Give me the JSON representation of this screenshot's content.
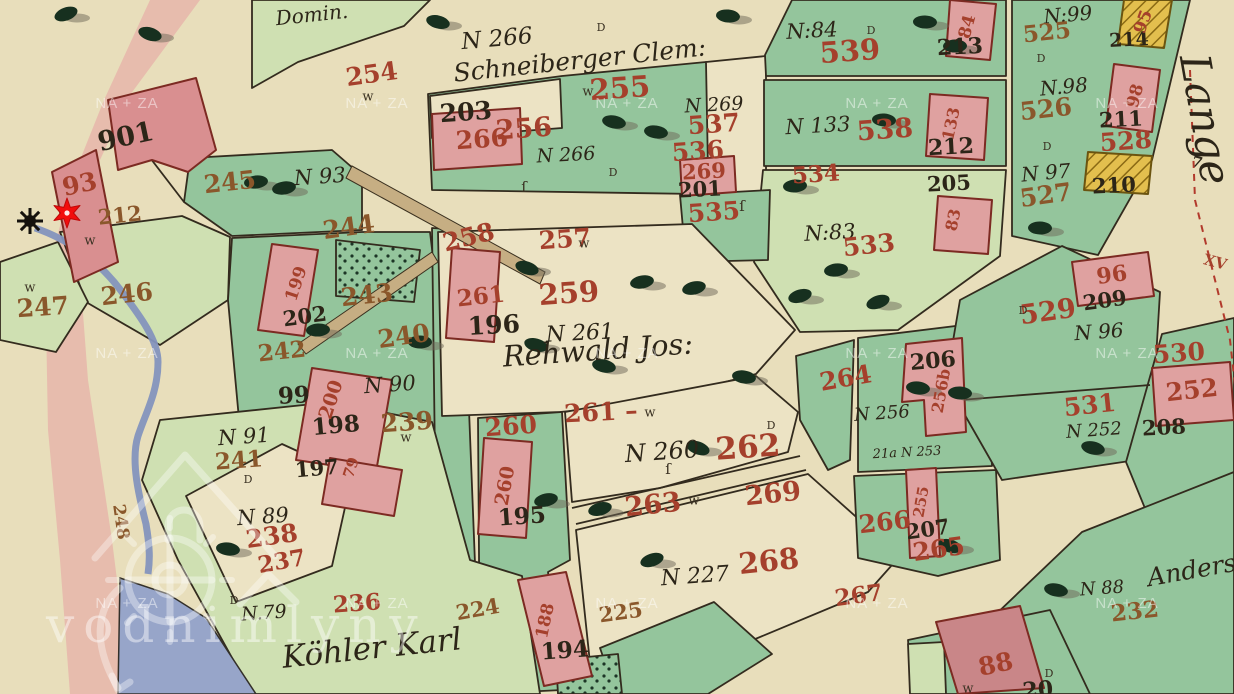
{
  "viewer": {
    "watermark": {
      "tile_text": "NA + ZA",
      "brand_text": "vodnimlyny",
      "logo_name": "vodnimlyny-watermill-logo",
      "tile_xs": [
        127,
        377,
        627,
        877,
        1127
      ],
      "tile_ys": [
        108,
        358,
        608
      ]
    },
    "marker": {
      "name": "mill-location-marker",
      "shape": "six-point-star",
      "color": "#f20d0d",
      "x": 67,
      "y": 213
    },
    "mill_wheel_symbol": {
      "x": 30,
      "y": 221
    }
  },
  "palette": {
    "paper": "#e8debb",
    "green_dark": "#94c59c",
    "green_light": "#cfe0b2",
    "cream_parcel": "#ece3c4",
    "building_pink": "#dfa1a0",
    "building_yellow": "#e3bf4e",
    "water": "#97a5c9",
    "road_band_pink": "#e6b6aa",
    "label_red": "#a5402c",
    "label_brown": "#8a572b",
    "ink": "#2c2518"
  },
  "labels": [
    {
      "t": "Domin.",
      "x": 312,
      "y": 16,
      "s": 20,
      "r": -6,
      "k": "script"
    },
    {
      "t": "Schneiberger Clem:",
      "x": 580,
      "y": 62,
      "s": 25,
      "r": -6,
      "k": "script"
    },
    {
      "t": "Rehwald Jos:",
      "x": 598,
      "y": 352,
      "s": 29,
      "r": -4,
      "k": "script"
    },
    {
      "t": "Köhler Karl",
      "x": 372,
      "y": 650,
      "s": 31,
      "r": -6,
      "k": "script"
    },
    {
      "t": "Anders",
      "x": 1192,
      "y": 572,
      "s": 25,
      "r": -10,
      "k": "script"
    },
    {
      "t": "Lange",
      "x": 1202,
      "y": 120,
      "s": 42,
      "r": 80,
      "k": "script"
    },
    {
      "t": "N 266",
      "x": 497,
      "y": 40,
      "s": 23,
      "r": -5,
      "k": "script"
    },
    {
      "t": "N 266",
      "x": 566,
      "y": 156,
      "s": 19,
      "r": -3,
      "k": "script"
    },
    {
      "t": "N 269",
      "x": 714,
      "y": 106,
      "s": 19,
      "r": -3,
      "k": "script"
    },
    {
      "t": "N:84",
      "x": 812,
      "y": 32,
      "s": 21,
      "r": -3,
      "k": "script"
    },
    {
      "t": "N 133",
      "x": 818,
      "y": 127,
      "s": 21,
      "r": -3,
      "k": "script"
    },
    {
      "t": "N:83",
      "x": 830,
      "y": 234,
      "s": 21,
      "r": -3,
      "k": "script"
    },
    {
      "t": "N:99",
      "x": 1068,
      "y": 16,
      "s": 20,
      "r": -5,
      "k": "script"
    },
    {
      "t": "N.98",
      "x": 1064,
      "y": 88,
      "s": 20,
      "r": -5,
      "k": "script"
    },
    {
      "t": "N 97",
      "x": 1046,
      "y": 174,
      "s": 20,
      "r": -5,
      "k": "script"
    },
    {
      "t": "N 93",
      "x": 320,
      "y": 178,
      "s": 21,
      "r": -4,
      "k": "script"
    },
    {
      "t": "N 90",
      "x": 390,
      "y": 386,
      "s": 21,
      "r": -4,
      "k": "script"
    },
    {
      "t": "N 91",
      "x": 244,
      "y": 438,
      "s": 21,
      "r": -4,
      "k": "script"
    },
    {
      "t": "N 89",
      "x": 263,
      "y": 518,
      "s": 21,
      "r": -4,
      "k": "script"
    },
    {
      "t": "N.79",
      "x": 264,
      "y": 614,
      "s": 19,
      "r": -4,
      "k": "script"
    },
    {
      "t": "N 261",
      "x": 580,
      "y": 334,
      "s": 22,
      "r": -3,
      "k": "script"
    },
    {
      "t": "N 260",
      "x": 662,
      "y": 453,
      "s": 24,
      "r": -4,
      "k": "script"
    },
    {
      "t": "N 227",
      "x": 695,
      "y": 577,
      "s": 22,
      "r": -4,
      "k": "script"
    },
    {
      "t": "N 256",
      "x": 882,
      "y": 414,
      "s": 18,
      "r": -4,
      "k": "script"
    },
    {
      "t": "N 96",
      "x": 1099,
      "y": 333,
      "s": 20,
      "r": -4,
      "k": "script"
    },
    {
      "t": "N 252",
      "x": 1094,
      "y": 431,
      "s": 18,
      "r": -4,
      "k": "script"
    },
    {
      "t": "N 88",
      "x": 1102,
      "y": 589,
      "s": 18,
      "r": -4,
      "k": "script"
    },
    {
      "t": "21a N 253",
      "x": 907,
      "y": 453,
      "s": 13,
      "r": -3,
      "k": "script"
    },
    {
      "t": "901",
      "x": 126,
      "y": 138,
      "s": 27,
      "r": -12,
      "k": "black"
    },
    {
      "t": "203",
      "x": 466,
      "y": 114,
      "s": 25,
      "r": -4,
      "k": "black"
    },
    {
      "t": "196",
      "x": 494,
      "y": 327,
      "s": 25,
      "r": -3,
      "k": "black"
    },
    {
      "t": "195",
      "x": 522,
      "y": 518,
      "s": 23,
      "r": -4,
      "k": "black"
    },
    {
      "t": "194",
      "x": 565,
      "y": 652,
      "s": 23,
      "r": -4,
      "k": "black"
    },
    {
      "t": "197",
      "x": 317,
      "y": 470,
      "s": 21,
      "r": -5,
      "k": "black"
    },
    {
      "t": "198",
      "x": 336,
      "y": 427,
      "s": 23,
      "r": -5,
      "k": "black"
    },
    {
      "t": "202",
      "x": 305,
      "y": 318,
      "s": 21,
      "r": -8,
      "k": "black"
    },
    {
      "t": "99",
      "x": 294,
      "y": 397,
      "s": 23,
      "r": -3,
      "k": "black"
    },
    {
      "t": "201",
      "x": 700,
      "y": 191,
      "s": 21,
      "r": -3,
      "k": "black"
    },
    {
      "t": "205",
      "x": 949,
      "y": 185,
      "s": 21,
      "r": -3,
      "k": "black"
    },
    {
      "t": "206",
      "x": 933,
      "y": 362,
      "s": 22,
      "r": -5,
      "k": "black"
    },
    {
      "t": "207",
      "x": 928,
      "y": 531,
      "s": 21,
      "r": -8,
      "k": "black"
    },
    {
      "t": "208",
      "x": 1164,
      "y": 429,
      "s": 21,
      "r": -3,
      "k": "black"
    },
    {
      "t": "209",
      "x": 1105,
      "y": 302,
      "s": 21,
      "r": -8,
      "k": "black"
    },
    {
      "t": "210",
      "x": 1114,
      "y": 187,
      "s": 21,
      "r": -3,
      "k": "black"
    },
    {
      "t": "211",
      "x": 1121,
      "y": 121,
      "s": 21,
      "r": -3,
      "k": "black"
    },
    {
      "t": "212",
      "x": 951,
      "y": 148,
      "s": 22,
      "r": -3,
      "k": "black"
    },
    {
      "t": "213",
      "x": 960,
      "y": 48,
      "s": 22,
      "r": -3,
      "k": "black"
    },
    {
      "t": "214",
      "x": 1129,
      "y": 41,
      "s": 19,
      "r": -3,
      "k": "black"
    },
    {
      "t": "20",
      "x": 1038,
      "y": 691,
      "s": 22,
      "r": -5,
      "k": "black"
    },
    {
      "t": "7",
      "x": 1197,
      "y": 163,
      "s": 15,
      "r": 15,
      "k": "black"
    },
    {
      "t": "93",
      "x": 80,
      "y": 186,
      "s": 25,
      "r": -12,
      "k": "red"
    },
    {
      "t": "212",
      "x": 120,
      "y": 217,
      "s": 21,
      "r": -6,
      "k": "brown"
    },
    {
      "t": "245",
      "x": 230,
      "y": 184,
      "s": 25,
      "r": -6,
      "k": "brown"
    },
    {
      "t": "244",
      "x": 349,
      "y": 229,
      "s": 25,
      "r": -8,
      "k": "brown"
    },
    {
      "t": "243",
      "x": 367,
      "y": 297,
      "s": 25,
      "r": -6,
      "k": "brown"
    },
    {
      "t": "246",
      "x": 127,
      "y": 296,
      "s": 25,
      "r": -6,
      "k": "brown"
    },
    {
      "t": "247",
      "x": 43,
      "y": 309,
      "s": 25,
      "r": -4,
      "k": "brown"
    },
    {
      "t": "242",
      "x": 282,
      "y": 353,
      "s": 23,
      "r": -6,
      "k": "brown"
    },
    {
      "t": "240",
      "x": 404,
      "y": 338,
      "s": 25,
      "r": -8,
      "k": "brown"
    },
    {
      "t": "241",
      "x": 239,
      "y": 462,
      "s": 23,
      "r": -4,
      "k": "brown"
    },
    {
      "t": "239",
      "x": 407,
      "y": 424,
      "s": 25,
      "r": -4,
      "k": "brown"
    },
    {
      "t": "238",
      "x": 272,
      "y": 538,
      "s": 25,
      "r": -8,
      "k": "red"
    },
    {
      "t": "237",
      "x": 282,
      "y": 563,
      "s": 23,
      "r": -10,
      "k": "red"
    },
    {
      "t": "236",
      "x": 357,
      "y": 605,
      "s": 23,
      "r": -4,
      "k": "red"
    },
    {
      "t": "224",
      "x": 478,
      "y": 611,
      "s": 21,
      "r": -10,
      "k": "brown"
    },
    {
      "t": "225",
      "x": 621,
      "y": 614,
      "s": 21,
      "r": -8,
      "k": "brown"
    },
    {
      "t": "248",
      "x": 120,
      "y": 522,
      "s": 17,
      "r": 82,
      "k": "brown"
    },
    {
      "t": "254",
      "x": 372,
      "y": 76,
      "s": 25,
      "r": -8,
      "k": "red"
    },
    {
      "t": "255",
      "x": 620,
      "y": 90,
      "s": 29,
      "r": -4,
      "k": "red"
    },
    {
      "t": "256",
      "x": 524,
      "y": 130,
      "s": 27,
      "r": -4,
      "k": "red"
    },
    {
      "t": "266",
      "x": 482,
      "y": 141,
      "s": 25,
      "r": -4,
      "k": "red"
    },
    {
      "t": "257",
      "x": 565,
      "y": 241,
      "s": 25,
      "r": -4,
      "k": "red"
    },
    {
      "t": "258",
      "x": 469,
      "y": 239,
      "s": 25,
      "r": -14,
      "k": "red"
    },
    {
      "t": "259",
      "x": 569,
      "y": 295,
      "s": 29,
      "r": -4,
      "k": "red"
    },
    {
      "t": "260",
      "x": 511,
      "y": 428,
      "s": 25,
      "r": -4,
      "k": "red"
    },
    {
      "t": "261",
      "x": 481,
      "y": 298,
      "s": 23,
      "r": -6,
      "k": "red"
    },
    {
      "t": "261 –",
      "x": 601,
      "y": 414,
      "s": 25,
      "r": -3,
      "k": "red"
    },
    {
      "t": "262",
      "x": 748,
      "y": 449,
      "s": 31,
      "r": -4,
      "k": "red"
    },
    {
      "t": "263",
      "x": 653,
      "y": 506,
      "s": 27,
      "r": -6,
      "k": "red"
    },
    {
      "t": "264",
      "x": 846,
      "y": 380,
      "s": 25,
      "r": -10,
      "k": "red"
    },
    {
      "t": "265",
      "x": 939,
      "y": 551,
      "s": 25,
      "r": -8,
      "k": "red"
    },
    {
      "t": "266",
      "x": 885,
      "y": 524,
      "s": 25,
      "r": -6,
      "k": "red"
    },
    {
      "t": "267",
      "x": 859,
      "y": 597,
      "s": 23,
      "r": -8,
      "k": "red"
    },
    {
      "t": "268",
      "x": 769,
      "y": 563,
      "s": 29,
      "r": -6,
      "k": "red"
    },
    {
      "t": "269",
      "x": 773,
      "y": 495,
      "s": 27,
      "r": -6,
      "k": "red"
    },
    {
      "t": "269",
      "x": 704,
      "y": 173,
      "s": 21,
      "r": -3,
      "k": "red"
    },
    {
      "t": "525",
      "x": 1047,
      "y": 34,
      "s": 23,
      "r": -6,
      "k": "brown"
    },
    {
      "t": "526",
      "x": 1046,
      "y": 111,
      "s": 25,
      "r": -6,
      "k": "brown"
    },
    {
      "t": "527",
      "x": 1046,
      "y": 197,
      "s": 25,
      "r": -8,
      "k": "brown"
    },
    {
      "t": "528",
      "x": 1126,
      "y": 143,
      "s": 25,
      "r": -4,
      "k": "red"
    },
    {
      "t": "529",
      "x": 1048,
      "y": 313,
      "s": 27,
      "r": -8,
      "k": "red"
    },
    {
      "t": "530",
      "x": 1179,
      "y": 355,
      "s": 25,
      "r": -4,
      "k": "red"
    },
    {
      "t": "531",
      "x": 1090,
      "y": 407,
      "s": 25,
      "r": -6,
      "k": "red"
    },
    {
      "t": "533",
      "x": 869,
      "y": 247,
      "s": 25,
      "r": -6,
      "k": "red"
    },
    {
      "t": "534",
      "x": 816,
      "y": 176,
      "s": 23,
      "r": -4,
      "k": "red"
    },
    {
      "t": "535",
      "x": 714,
      "y": 214,
      "s": 25,
      "r": -4,
      "k": "red"
    },
    {
      "t": "536",
      "x": 698,
      "y": 153,
      "s": 25,
      "r": -4,
      "k": "red"
    },
    {
      "t": "537",
      "x": 714,
      "y": 126,
      "s": 25,
      "r": -4,
      "k": "red"
    },
    {
      "t": "538",
      "x": 885,
      "y": 131,
      "s": 27,
      "r": -4,
      "k": "red"
    },
    {
      "t": "539",
      "x": 850,
      "y": 53,
      "s": 29,
      "r": -4,
      "k": "red"
    },
    {
      "t": "232",
      "x": 1135,
      "y": 613,
      "s": 23,
      "r": -6,
      "k": "brown"
    },
    {
      "t": "88",
      "x": 996,
      "y": 666,
      "s": 25,
      "r": -12,
      "k": "red"
    },
    {
      "t": "XV",
      "x": 1215,
      "y": 263,
      "s": 15,
      "r": 15,
      "k": "red"
    },
    {
      "t": "95",
      "x": 1144,
      "y": 22,
      "s": 17,
      "r": -70,
      "k": "red"
    },
    {
      "t": "98",
      "x": 1136,
      "y": 96,
      "s": 17,
      "r": -75,
      "k": "red"
    },
    {
      "t": "84",
      "x": 968,
      "y": 27,
      "s": 17,
      "r": -75,
      "k": "red"
    },
    {
      "t": "133",
      "x": 952,
      "y": 124,
      "s": 16,
      "r": -78,
      "k": "red"
    },
    {
      "t": "83",
      "x": 954,
      "y": 220,
      "s": 16,
      "r": -78,
      "k": "red"
    },
    {
      "t": "96",
      "x": 1112,
      "y": 276,
      "s": 22,
      "r": -8,
      "k": "red"
    },
    {
      "t": "252",
      "x": 1192,
      "y": 392,
      "s": 25,
      "r": -6,
      "k": "red"
    },
    {
      "t": "256b",
      "x": 942,
      "y": 391,
      "s": 16,
      "r": -80,
      "k": "red"
    },
    {
      "t": "255",
      "x": 922,
      "y": 502,
      "s": 15,
      "r": -80,
      "k": "red"
    },
    {
      "t": "199",
      "x": 297,
      "y": 284,
      "s": 17,
      "r": -72,
      "k": "red"
    },
    {
      "t": "200",
      "x": 332,
      "y": 400,
      "s": 19,
      "r": -72,
      "k": "red"
    },
    {
      "t": "79",
      "x": 352,
      "y": 468,
      "s": 15,
      "r": -72,
      "k": "red"
    },
    {
      "t": "188",
      "x": 546,
      "y": 621,
      "s": 17,
      "r": -78,
      "k": "red"
    },
    {
      "t": "260",
      "x": 506,
      "y": 486,
      "s": 19,
      "r": -80,
      "k": "red"
    },
    {
      "t": "w",
      "x": 368,
      "y": 97,
      "s": 13,
      "r": 0,
      "k": "mark"
    },
    {
      "t": "w",
      "x": 588,
      "y": 92,
      "s": 13,
      "r": 0,
      "k": "mark"
    },
    {
      "t": "w",
      "x": 584,
      "y": 244,
      "s": 13,
      "r": 0,
      "k": "mark"
    },
    {
      "t": "w",
      "x": 650,
      "y": 413,
      "s": 13,
      "r": 0,
      "k": "mark"
    },
    {
      "t": "w",
      "x": 694,
      "y": 501,
      "s": 13,
      "r": 0,
      "k": "mark"
    },
    {
      "t": "w",
      "x": 90,
      "y": 241,
      "s": 13,
      "r": 0,
      "k": "mark"
    },
    {
      "t": "w",
      "x": 30,
      "y": 288,
      "s": 13,
      "r": 0,
      "k": "mark"
    },
    {
      "t": "w",
      "x": 406,
      "y": 438,
      "s": 13,
      "r": 0,
      "k": "mark"
    },
    {
      "t": "w",
      "x": 968,
      "y": 689,
      "s": 13,
      "r": 0,
      "k": "mark"
    },
    {
      "t": "ſ",
      "x": 742,
      "y": 207,
      "s": 15,
      "r": 0,
      "k": "mark"
    },
    {
      "t": "ſ",
      "x": 668,
      "y": 470,
      "s": 15,
      "r": 0,
      "k": "mark"
    },
    {
      "t": "ſ",
      "x": 524,
      "y": 188,
      "s": 15,
      "r": 0,
      "k": "mark"
    },
    {
      "t": "D",
      "x": 601,
      "y": 28,
      "s": 11,
      "r": 0,
      "k": "mark"
    },
    {
      "t": "D",
      "x": 871,
      "y": 31,
      "s": 11,
      "r": 0,
      "k": "mark"
    },
    {
      "t": "D",
      "x": 613,
      "y": 173,
      "s": 11,
      "r": 0,
      "k": "mark"
    },
    {
      "t": "D",
      "x": 1041,
      "y": 59,
      "s": 11,
      "r": 0,
      "k": "mark"
    },
    {
      "t": "D",
      "x": 1047,
      "y": 147,
      "s": 11,
      "r": 0,
      "k": "mark"
    },
    {
      "t": "D",
      "x": 248,
      "y": 480,
      "s": 11,
      "r": 0,
      "k": "mark"
    },
    {
      "t": "D",
      "x": 771,
      "y": 426,
      "s": 11,
      "r": 0,
      "k": "mark"
    },
    {
      "t": "D",
      "x": 1023,
      "y": 311,
      "s": 11,
      "r": 0,
      "k": "mark"
    },
    {
      "t": "D",
      "x": 234,
      "y": 601,
      "s": 11,
      "r": 0,
      "k": "mark"
    },
    {
      "t": "D",
      "x": 1049,
      "y": 674,
      "s": 11,
      "r": 0,
      "k": "mark"
    }
  ]
}
